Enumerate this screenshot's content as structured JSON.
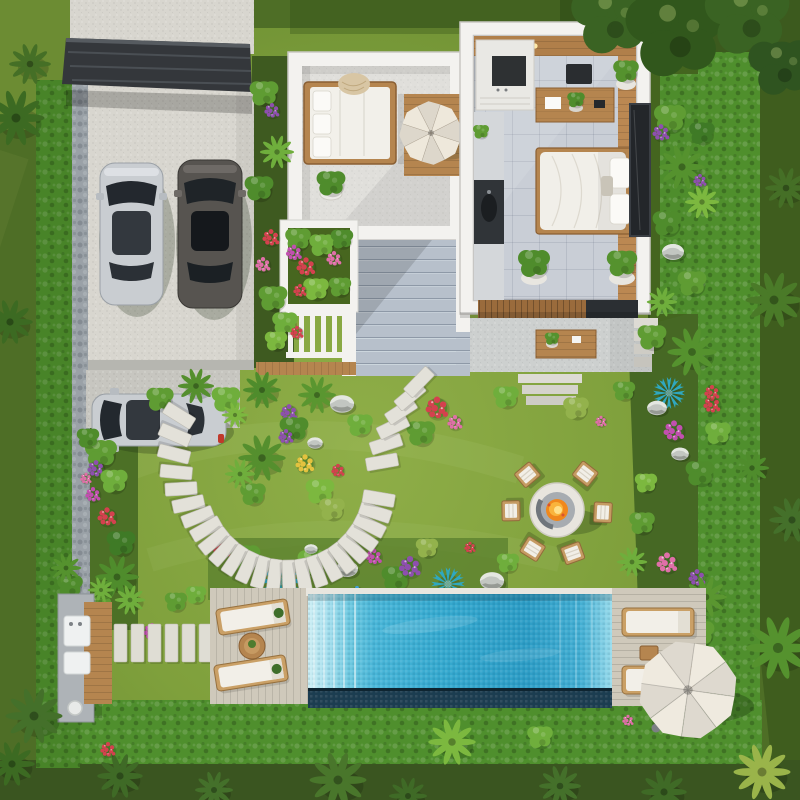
{
  "meta": {
    "title": "Top-down aerial 3D render of a modern white villa with landscaped garden, carport, fire pit lounge and swimming pool",
    "view": "top-down aerial",
    "style": "photorealistic architectural visualization",
    "no_visible_text": true
  },
  "palette": {
    "grass-outer": "#4e6e26",
    "grass-outer-dark": "#3a5520",
    "grass-inner": "#7fa03c",
    "grass-bright": "#93b24c",
    "hedge": "#4f8f2d",
    "hedge-dark": "#2f6018",
    "soil": "#3e5a20",
    "stone-wall": "#9aa1a7",
    "concrete": "#d8d6cf",
    "concrete-dim": "#c7c6c0",
    "steps": "#b7c0cb",
    "steps-line": "#8e99a7",
    "bld": "#f3f2ef",
    "bld-shade": "#d8d7d3",
    "floor-terrace": "#e0dfdb",
    "floor-tile": "#c9ced6",
    "wood": "#b5854f",
    "wood-dark": "#8a5f33",
    "wood-light": "#c8995f",
    "deck": "#cfc9bb",
    "deck-line": "#b2a998",
    "carport": "#34373b",
    "car-silver": "#c9cdd1",
    "car-dark": "#575450",
    "glass": "#23282e",
    "pool-band": "#1d3d50",
    "coping": "#e8e6df",
    "cream": "#f0ebe0",
    "cushion": "#f2efe8",
    "fire": "#f0881c",
    "fire-core": "#ffe08a",
    "ring": "#e8e5de",
    "ring-inner": "#a7acb1"
  },
  "inventory": [
    "flat-roof carport sheltering two parked cars",
    "third silver car parked on the side drive",
    "stone-clad boundary wall wrapped by clipped hedges",
    "white villa rooftop terrace with daybed, throw blanket, potted plant and open parasol",
    "open-top (cutaway) studio bedroom with kitchenette, timber ceiling, desk, double bed and leaning art panel",
    "wide concrete garden stair between the two volumes",
    "raised planter full of flowering shrubs and a white balustrade",
    "circular stepping-stone path looping a planted island",
    "round fire pit with burning fire and six timber armchairs",
    "rectangular swimming pool with entry steps and dark infinity edge",
    "two timber pool decks with four sun loungers and side tables",
    "large white parasol over the far pool deck",
    "outdoor kitchen bench with timber counter",
    "tropical planting: palms, agave-like blue rosettes, colourful flower drifts, boulders"
  ],
  "counts": {
    "cars": 3,
    "firepit_chairs": 6,
    "sun_loungers": 4,
    "parasols": 2,
    "pools": 1,
    "buildings": 2
  },
  "scene": {
    "stone_ring": {
      "cx": 287,
      "cy": 483,
      "r": 93,
      "startDeg": 212,
      "endDeg": 8,
      "stepDeg": 8.8,
      "flareStart": 155,
      "flareRate": 0.6,
      "w": 32,
      "h": 13
    },
    "tail_stones": [
      [
        382,
        462,
        -10
      ],
      [
        386,
        444,
        -18
      ],
      [
        393,
        427,
        -26
      ],
      [
        401,
        411,
        -33
      ],
      [
        410,
        396,
        -40
      ],
      [
        419,
        382,
        -46
      ]
    ],
    "path_slabs": {
      "y": 624,
      "h": 38,
      "w": 13,
      "xs": [
        114,
        131,
        148,
        165,
        182,
        199
      ]
    },
    "firepit": {
      "cx": 557,
      "cy": 510,
      "chairDist": 46,
      "chairBearings": [
        230,
        308,
        179,
        3,
        122,
        70
      ]
    },
    "vegetation": [
      [
        "bush",
        101,
        452,
        1,
        "#5f9c33"
      ],
      [
        "flowers",
        96,
        468,
        0.9,
        "#8e4fae"
      ],
      [
        "bush",
        114,
        480,
        0.85,
        "#6fae3c"
      ],
      [
        "flowers",
        107,
        516,
        1,
        "#d4414e"
      ],
      [
        "bush",
        121,
        542,
        0.9,
        "#3f7a26"
      ],
      [
        "palm",
        117,
        577,
        1.15,
        "#4f8c2c"
      ],
      [
        "flowers",
        93,
        494,
        0.8,
        "#c24fb0"
      ],
      [
        "bush",
        97,
        607,
        0.9,
        "#5f9c33"
      ],
      [
        "palm",
        130,
        600,
        0.8,
        "#6fae3c"
      ],
      [
        "bush",
        88,
        437,
        0.7,
        "#4f8c2c"
      ],
      [
        "flowers",
        86,
        478,
        0.6,
        "#e06fa8"
      ],
      [
        "bush",
        160,
        398,
        0.85,
        "#5f9c33"
      ],
      [
        "palm",
        196,
        386,
        0.95,
        "#558f2e"
      ],
      [
        "bush",
        226,
        398,
        0.9,
        "#6fae3c"
      ],
      [
        "palm",
        262,
        390,
        1,
        "#4f8c2c"
      ],
      [
        "flowers",
        289,
        412,
        0.9,
        "#8e4fae"
      ],
      [
        "palm",
        317,
        395,
        1,
        "#5a9630"
      ],
      [
        "rock",
        342,
        404,
        1.1,
        ""
      ],
      [
        "bush",
        360,
        424,
        0.8,
        "#6fae3c"
      ],
      [
        "flowers",
        437,
        407,
        1.2,
        "#d4414e"
      ],
      [
        "flowers",
        455,
        422,
        0.8,
        "#e06fa8"
      ],
      [
        "bush",
        421,
        432,
        0.9,
        "#5f9c33"
      ],
      [
        "palm",
        235,
        415,
        0.7,
        "#7cb83f"
      ],
      [
        "palm",
        262,
        458,
        1.25,
        "#558f2e"
      ],
      [
        "bush",
        294,
        428,
        0.9,
        "#4f8c2c"
      ],
      [
        "flowers",
        305,
        463,
        1,
        "#e3c23f"
      ],
      [
        "bush",
        320,
        490,
        0.9,
        "#7cb83f"
      ],
      [
        "flowers",
        286,
        436,
        0.8,
        "#8e4fae"
      ],
      [
        "bush",
        253,
        493,
        0.8,
        "#5f9c33"
      ],
      [
        "rock",
        315,
        443,
        0.7,
        ""
      ],
      [
        "bush",
        332,
        508,
        0.8,
        "#93b24c"
      ],
      [
        "palm",
        240,
        474,
        0.8,
        "#6fae3c"
      ],
      [
        "flowers",
        338,
        470,
        0.7,
        "#d4414e"
      ],
      [
        "flowers",
        222,
        549,
        0.9,
        "#d4414e"
      ],
      [
        "bush",
        246,
        556,
        0.9,
        "#5f9c33"
      ],
      [
        "agave",
        281,
        581,
        1.25,
        "#2fa8c0"
      ],
      [
        "bush",
        312,
        561,
        0.9,
        "#6fae3c"
      ],
      [
        "rock",
        347,
        569,
        1,
        ""
      ],
      [
        "flowers",
        374,
        556,
        0.85,
        "#c24fb0"
      ],
      [
        "bush",
        396,
        577,
        0.9,
        "#4f8c2c"
      ],
      [
        "flowers",
        410,
        566,
        1.15,
        "#8e4fae"
      ],
      [
        "agave",
        448,
        584,
        1.05,
        "#2fa8c0"
      ],
      [
        "rock",
        311,
        549,
        0.6,
        ""
      ],
      [
        "bush",
        427,
        547,
        0.7,
        "#93b24c"
      ],
      [
        "flowers",
        357,
        592,
        0.7,
        "#3f9fd9"
      ],
      [
        "rock",
        492,
        581,
        1.1,
        ""
      ],
      [
        "flowers",
        470,
        547,
        0.6,
        "#d4414e"
      ],
      [
        "bush",
        508,
        562,
        0.7,
        "#6fae3c"
      ],
      [
        "palm",
        692,
        352,
        1.3,
        "#55922e"
      ],
      [
        "bush",
        652,
        336,
        0.9,
        "#5f9c33"
      ],
      [
        "agave",
        669,
        393,
        1,
        "#2fa8c0"
      ],
      [
        "rock",
        657,
        408,
        0.9,
        ""
      ],
      [
        "flowers",
        674,
        430,
        1.1,
        "#c24fb0"
      ],
      [
        "rock",
        680,
        454,
        0.8,
        ""
      ],
      [
        "bush",
        700,
        472,
        0.9,
        "#4f8c2c"
      ],
      [
        "flowers",
        667,
        562,
        1.1,
        "#e06fa8"
      ],
      [
        "flowers",
        697,
        577,
        0.9,
        "#8e4fae"
      ],
      [
        "palm",
        706,
        597,
        1.1,
        "#5a9630"
      ],
      [
        "bush",
        642,
        522,
        0.8,
        "#5f9c33"
      ],
      [
        "palm",
        632,
        562,
        0.8,
        "#6fae3c"
      ],
      [
        "bush",
        718,
        432,
        0.8,
        "#6fae3c"
      ],
      [
        "flowers",
        712,
        404,
        0.9,
        "#d4414e"
      ],
      [
        "bush",
        646,
        482,
        0.7,
        "#7cb83f"
      ],
      [
        "bush",
        700,
        632,
        0.9,
        "#5f9c33"
      ],
      [
        "flowers",
        650,
        610,
        0.7,
        "#c24fb0"
      ],
      [
        "bush",
        670,
        117,
        1,
        "#5f9c33"
      ],
      [
        "flowers",
        661,
        132,
        0.9,
        "#8e4fae"
      ],
      [
        "palm",
        682,
        167,
        1.2,
        "#55922e"
      ],
      [
        "palm",
        702,
        202,
        0.9,
        "#7cb83f"
      ],
      [
        "bush",
        667,
        222,
        0.9,
        "#4f8c2c"
      ],
      [
        "rock",
        673,
        252,
        1,
        ""
      ],
      [
        "bush",
        692,
        282,
        0.9,
        "#5f9c33"
      ],
      [
        "palm",
        662,
        302,
        0.8,
        "#6fae3c"
      ],
      [
        "bush",
        702,
        132,
        0.8,
        "#3f7a26"
      ],
      [
        "bush",
        264,
        92,
        0.9,
        "#5f9c33"
      ],
      [
        "flowers",
        272,
        110,
        0.8,
        "#8e4fae"
      ],
      [
        "palm",
        277,
        152,
        0.9,
        "#6fae3c"
      ],
      [
        "bush",
        259,
        187,
        0.9,
        "#4f8c2c"
      ],
      [
        "flowers",
        271,
        237,
        0.9,
        "#d4414e"
      ],
      [
        "flowers",
        263,
        264,
        0.8,
        "#e06fa8"
      ],
      [
        "bush",
        273,
        297,
        0.9,
        "#5f9c33"
      ],
      [
        "bush",
        285,
        322,
        0.8,
        "#6fae3c"
      ],
      [
        "flowers",
        297,
        332,
        0.7,
        "#d4414e"
      ],
      [
        "bush",
        276,
        340,
        0.7,
        "#7cb83f"
      ],
      [
        "bush",
        506,
        396,
        0.8,
        "#6fae3c"
      ],
      [
        "bush",
        576,
        407,
        0.8,
        "#93b24c"
      ],
      [
        "flowers",
        601,
        421,
        0.6,
        "#e06fa8"
      ],
      [
        "bush",
        624,
        390,
        0.7,
        "#5f9c33"
      ],
      [
        "flowers",
        152,
        631,
        0.9,
        "#c24fb0"
      ],
      [
        "bush",
        176,
        601,
        0.7,
        "#5f9c33"
      ],
      [
        "bush",
        70,
        585,
        0.8,
        "#4f8c2c"
      ],
      [
        "palm",
        101,
        590,
        0.7,
        "#6fae3c"
      ],
      [
        "bush",
        196,
        594,
        0.65,
        "#6fae3c"
      ],
      [
        "bush",
        298,
        238,
        0.8,
        "#5f9c33"
      ],
      [
        "flowers",
        294,
        252,
        0.85,
        "#c24fb0"
      ],
      [
        "flowers",
        306,
        266,
        1,
        "#d4414e"
      ],
      [
        "bush",
        322,
        244,
        0.8,
        "#6fae3c"
      ],
      [
        "flowers",
        334,
        258,
        0.8,
        "#e06fa8"
      ],
      [
        "bush",
        342,
        238,
        0.7,
        "#4f8c2c"
      ],
      [
        "bush",
        316,
        288,
        0.8,
        "#7cb83f"
      ],
      [
        "flowers",
        300,
        290,
        0.7,
        "#d4414e"
      ],
      [
        "bush",
        340,
        286,
        0.7,
        "#5f9c33"
      ],
      [
        "bush",
        331,
        182,
        0.9,
        "#4f8c2c"
      ],
      [
        "bush",
        534,
        262,
        1,
        "#4f8c2c"
      ],
      [
        "bush",
        622,
        262,
        0.95,
        "#55922e"
      ],
      [
        "bush",
        576,
        99,
        0.55,
        "#4f8c2c"
      ],
      [
        "bush",
        552,
        338,
        0.45,
        "#55922e"
      ],
      [
        "bush",
        481,
        131,
        0.5,
        "#5f9c33"
      ],
      [
        "bush",
        626,
        70,
        0.8,
        "#55922e"
      ]
    ],
    "flora_over": [
      [
        "canopy",
        612,
        16,
        1.7,
        "#3a6323"
      ],
      [
        "canopy",
        676,
        30,
        2.1,
        "#31571c"
      ],
      [
        "canopy",
        748,
        14,
        1.8,
        "#3a6323"
      ],
      [
        "canopy",
        782,
        64,
        1.4,
        "#2f5420"
      ],
      [
        "palm",
        16,
        118,
        1.5,
        "#3c6a22"
      ],
      [
        "palm",
        30,
        64,
        1.1,
        "#456f26"
      ],
      [
        "palm",
        10,
        322,
        1.2,
        "#3c6a22"
      ],
      [
        "palm",
        34,
        716,
        1.5,
        "#44702a"
      ],
      [
        "palm",
        12,
        764,
        1.2,
        "#3c6a22"
      ],
      [
        "palm",
        120,
        776,
        1.2,
        "#3f6a26"
      ],
      [
        "palm",
        214,
        790,
        1,
        "#44702a"
      ],
      [
        "palm",
        338,
        780,
        1.5,
        "#49762b"
      ],
      [
        "palm",
        408,
        796,
        1,
        "#3f6a26"
      ],
      [
        "palm",
        452,
        742,
        1.25,
        "#7cb83f"
      ],
      [
        "palm",
        560,
        786,
        1.1,
        "#44702a"
      ],
      [
        "palm",
        664,
        792,
        1.2,
        "#3f6a26"
      ],
      [
        "palm",
        762,
        772,
        1.5,
        "#9ab44a"
      ],
      [
        "palm",
        774,
        300,
        1.5,
        "#4a7a28"
      ],
      [
        "palm",
        786,
        188,
        1.1,
        "#456f26"
      ],
      [
        "palm",
        778,
        648,
        1.7,
        "#55922e"
      ],
      [
        "palm",
        792,
        520,
        1.2,
        "#44702a"
      ],
      [
        "palm",
        752,
        468,
        0.9,
        "#4f8c2c"
      ],
      [
        "flowers",
        108,
        749,
        0.8,
        "#d4414e"
      ],
      [
        "flowers",
        700,
        180,
        0.7,
        "#8e4fae"
      ],
      [
        "flowers",
        712,
        392,
        0.8,
        "#d4414e"
      ],
      [
        "bush",
        540,
        736,
        0.8,
        "#6fae3c"
      ],
      [
        "flowers",
        628,
        720,
        0.6,
        "#e06fa8"
      ],
      [
        "palm",
        66,
        568,
        0.8,
        "#55922e"
      ]
    ]
  }
}
